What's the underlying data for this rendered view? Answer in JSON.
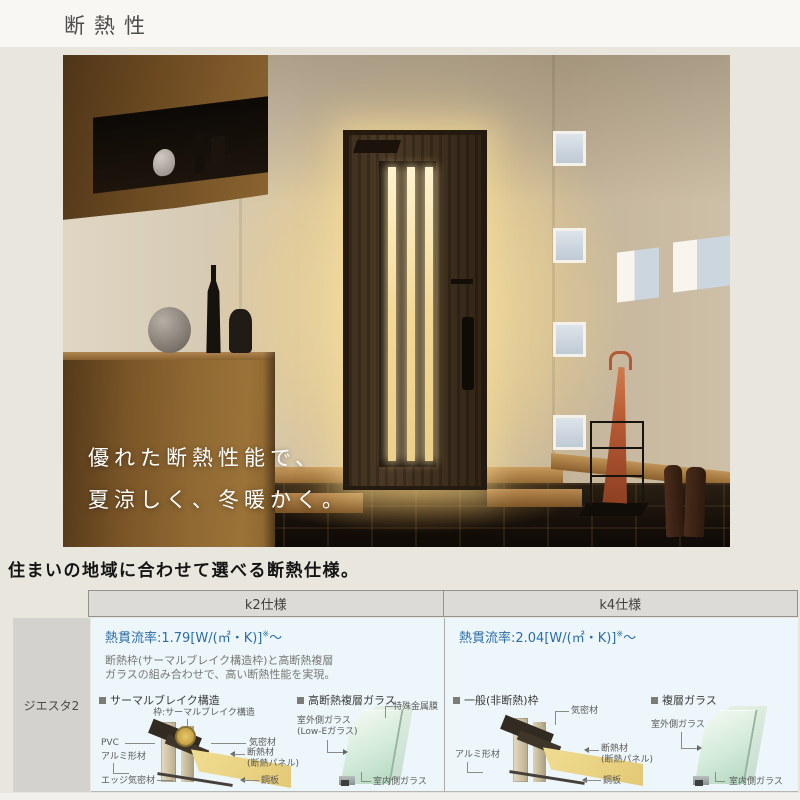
{
  "page": {
    "title": "断熱性"
  },
  "hero": {
    "caption_line1": "優れた断熱性能で、",
    "caption_line2": "夏涼しく、冬暖かく。"
  },
  "section_heading": "住まいの地域に合わせて選べる断熱仕様。",
  "table": {
    "row_label": "ジエスタ2",
    "columns": [
      {
        "header": "k2仕様",
        "u_value": "熱貫流率:1.79[W/(㎡・K)]",
        "u_value_note": "※",
        "u_value_tilde": "〜",
        "description_line1": "断熱枠(サーマルブレイク構造枠)と高断熱複層",
        "description_line2": "ガラスの組み合わせで、高い断熱性能を実現。",
        "frame_diagram": {
          "title": "サーマルブレイク構造",
          "labels": {
            "frame_note": "枠:サーマルブレイク構造",
            "pvc": "PVC",
            "airtight": "気密材",
            "aluminum": "アルミ形材",
            "insulation": "断熱材",
            "insulation_sub": "(断熱パネル)",
            "edge": "エッジ気密材",
            "steel": "鋼板"
          }
        },
        "glass_diagram": {
          "title": "高断熱複層ガラス",
          "labels": {
            "film": "特殊金属膜",
            "outer": "室外側ガラス",
            "outer_sub": "(Low-Eガラス)",
            "inner": "室内側ガラス"
          }
        }
      },
      {
        "header": "k4仕様",
        "u_value": "熱貫流率:2.04[W/(㎡・K)]",
        "u_value_note": "※",
        "u_value_tilde": "〜",
        "frame_diagram": {
          "title": "一般(非断熱)枠",
          "labels": {
            "airtight": "気密材",
            "aluminum": "アルミ形材",
            "insulation": "断熱材",
            "insulation_sub": "(断熱パネル)",
            "steel": "鋼板"
          }
        },
        "glass_diagram": {
          "title": "複層ガラス",
          "labels": {
            "outer": "室外側ガラス",
            "inner": "室内側ガラス"
          }
        }
      }
    ]
  },
  "colors": {
    "accent_blue": "#2c6da6",
    "header_bg": "#dcdbd7",
    "cell_bg": "#edf6fa",
    "row_label_bg": "#d3d2cf",
    "page_bg": "#e9e6de"
  }
}
